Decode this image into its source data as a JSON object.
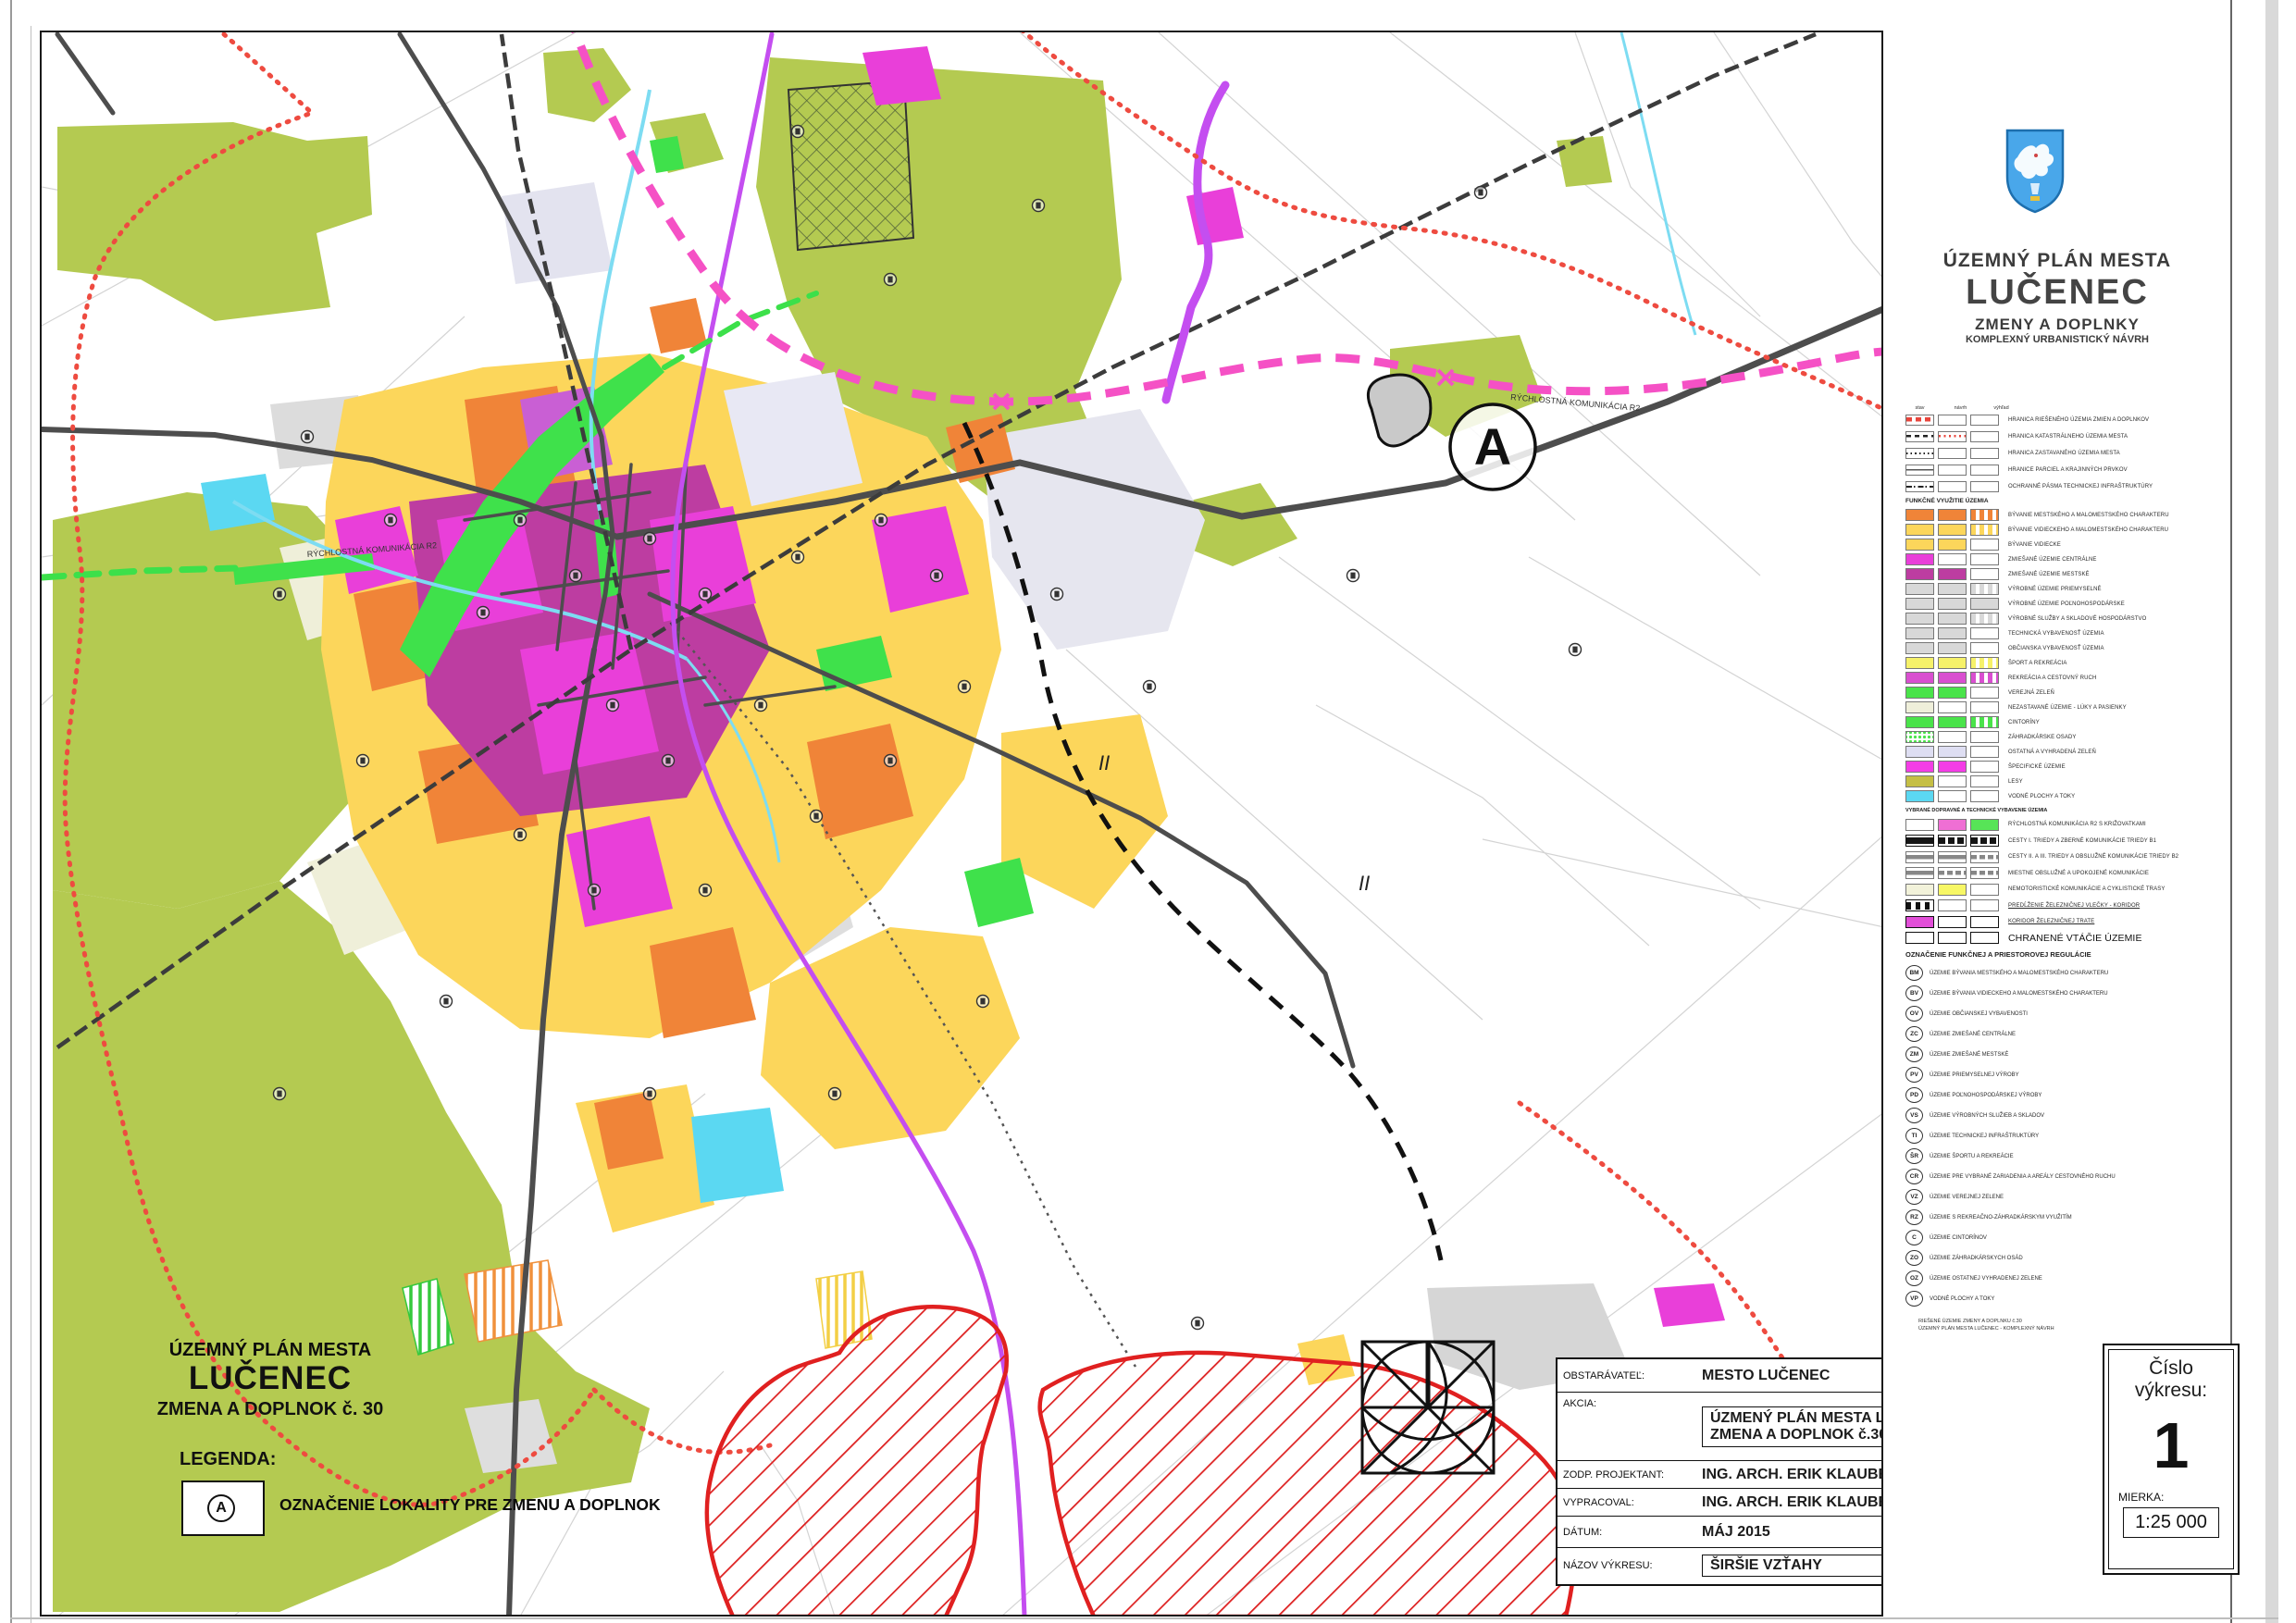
{
  "panel": {
    "title1": "ÚZEMNÝ PLÁN MESTA",
    "title2": "LUČENEC",
    "title3": "ZMENY A DOPLNKY",
    "title4": "KOMPLEXNÝ URBANISTICKÝ NÁVRH",
    "coat_of_arms_icon": "lucenec-coat-of-arms",
    "col_headers": [
      "stav",
      "návrh",
      "výhľad"
    ],
    "line_items": [
      {
        "s": [
          "line-red-dash",
          "none",
          "none"
        ],
        "label": "HRANICA RIEŠENÉHO ÚZEMIA ZMIEN A DOPLNKOV"
      },
      {
        "s": [
          "line-black-dash",
          "dots-red",
          "none"
        ],
        "label": "HRANICA KATASTRÁLNEHO ÚZEMIA MESTA"
      },
      {
        "s": [
          "line-black-dots",
          "none",
          "none"
        ],
        "label": "HRANICA ZASTAVANÉHO ÚZEMIA MESTA"
      },
      {
        "s": [
          "line-thin",
          "none",
          "none"
        ],
        "label": "HRANICE PARCIEL A KRAJINNÝCH PRVKOV"
      },
      {
        "s": [
          "line-dashdot",
          "none",
          "none"
        ],
        "label": "OCHRANNÉ PÁSMA TECHNICKEJ INFRAŠTRUKTÚRY"
      }
    ],
    "section_a_header": "FUNKČNÉ VYUŽITIE ÚZEMIA",
    "area_items": [
      {
        "s": [
          "#f08438",
          "#f08438",
          "stripe:#f08438"
        ],
        "label": "BÝVANIE MESTSKÉHO A MALOMESTSKÉHO CHARAKTERU"
      },
      {
        "s": [
          "#fcd65b",
          "#fcd65b",
          "stripe:#fcd65b"
        ],
        "label": "BÝVANIE VIDIECKEHO A MALOMESTSKÉHO CHARAKTERU"
      },
      {
        "s": [
          "#fcd65b",
          "#fcd65b",
          "none"
        ],
        "label": "BÝVANIE VIDIECKE"
      },
      {
        "s": [
          "#e93fd9",
          "none",
          "none"
        ],
        "label": "ZMIEŠANÉ ÚZEMIE CENTRÁLNE"
      },
      {
        "s": [
          "#bd3da1",
          "#bd3da1",
          "none"
        ],
        "label": "ZMIEŠANÉ ÚZEMIE MESTSKÉ"
      },
      {
        "s": [
          "#d8d8d8",
          "#d8d8d8",
          "stripe:#d8d8d8"
        ],
        "label": "VÝROBNÉ ÚZEMIE PRIEMYSELNÉ"
      },
      {
        "s": [
          "#d8d8d8",
          "#d8d8d8",
          "#d8d8d8"
        ],
        "label": "VÝROBNÉ ÚZEMIE POĽNOHOSPODÁRSKE"
      },
      {
        "s": [
          "#d8d8d8",
          "#d8d8d8",
          "stripe:#d8d8d8"
        ],
        "label": "VÝROBNÉ SLUŽBY A SKLADOVÉ HOSPODÁRSTVO"
      },
      {
        "s": [
          "#d8d8d8",
          "#d8d8d8",
          "none"
        ],
        "label": "TECHNICKÁ VYBAVENOSŤ ÚZEMIA"
      },
      {
        "s": [
          "#d8d8d8",
          "#d8d8d8",
          "none"
        ],
        "label": "OBČIANSKA VYBAVENOSŤ ÚZEMIA"
      },
      {
        "s": [
          "#f6f169",
          "#f6f169",
          "stripe:#f6f169"
        ],
        "label": "ŠPORT A REKREÁCIA"
      },
      {
        "s": [
          "#d94fd0",
          "#d94fd0",
          "stripe:#d94fd0"
        ],
        "label": "REKREÁCIA A CESTOVNÝ RUCH"
      },
      {
        "s": [
          "#4ae34a",
          "#4ae34a",
          "none"
        ],
        "label": "VEREJNÁ ZELEŇ"
      },
      {
        "s": [
          "#efefda",
          "none",
          "none"
        ],
        "label": "NEZASTAVANÉ ÚZEMIE - LÚKY A PASIENKY"
      },
      {
        "s": [
          "#4ae34a",
          "#4ae34a",
          "stripe:#4ae34a"
        ],
        "label": "CINTORÍNY"
      },
      {
        "s": [
          "dots:#4ae34a",
          "none",
          "none"
        ],
        "label": "ZÁHRADKÁRSKE OSADY"
      },
      {
        "s": [
          "#dedef2",
          "#dedef2",
          "none"
        ],
        "label": "OSTATNÁ A VYHRADENÁ ZELEŇ"
      },
      {
        "s": [
          "#f43de6",
          "#f43de6",
          "none"
        ],
        "label": "ŠPECIFICKÉ ÚZEMIE"
      },
      {
        "s": [
          "#c5bf45",
          "none",
          "none"
        ],
        "label": "LESY"
      },
      {
        "s": [
          "#5bd8f2",
          "none",
          "none"
        ],
        "label": "VODNÉ PLOCHY A TOKY"
      }
    ],
    "transport_header": "VYBRANÉ DOPRAVNÉ A TECHNICKÉ VYBAVENIE ÚZEMIA",
    "transport_items": [
      {
        "s": [
          "none",
          "#ef6fd4",
          "#57e457"
        ],
        "label": "RÝCHLOSTNÁ KOMUNIKÁCIA R2 S KRIŽOVATKAMI"
      },
      {
        "s": [
          "bar-black",
          "bar-black-seg",
          "bar-black-seg"
        ],
        "label": "CESTY I. TRIEDY A ZBERNÉ KOMUNIKÁCIE TRIEDY B1"
      },
      {
        "s": [
          "bar-gray",
          "bar-gray",
          "bar-gray-seg"
        ],
        "label": "CESTY II. A III. TRIEDY A OBSLUŽNÉ KOMUNIKÁCIE TRIEDY B2"
      },
      {
        "s": [
          "bar-gray",
          "bar-gray-seg",
          "bar-gray-seg"
        ],
        "label": "MIESTNE OBSLUŽNÉ A UPOKOJENÉ KOMUNIKÁCIE"
      },
      {
        "s": [
          "#f2f2da",
          "#f7f765",
          "none"
        ],
        "label": "NEMOTORISTICKÉ KOMUNIKÁCIE A CYKLISTICKÉ TRASY"
      },
      {
        "s": [
          "rail",
          "none",
          "none"
        ],
        "label": "PREDĹŽENIE ŽELEZNIČNEJ VLEČKY - KORIDOR",
        "u": true
      },
      {
        "s": [
          "magenta-border",
          "border-bold",
          "border-bold"
        ],
        "label": "KORIDOR ŽELEZNIČNEJ TRATE",
        "u": true
      },
      {
        "s": [
          "border-bold",
          "border-bold",
          "border-bold"
        ],
        "label": "CHRANENÉ VTÁČIE ÚZEMIE",
        "big": true
      }
    ],
    "section_b_header": "OZNAČENIE FUNKČNEJ A PRIESTOROVEJ REGULÁCIE",
    "code_items": [
      {
        "code": "BM",
        "label": "ÚZEMIE BÝVANIA MESTSKÉHO A MALOMESTSKÉHO CHARAKTERU"
      },
      {
        "code": "BV",
        "label": "ÚZEMIE BÝVANIA VIDIECKEHO A MALOMESTSKÉHO CHARAKTERU"
      },
      {
        "code": "OV",
        "label": "ÚZEMIE OBČIANSKEJ VYBAVENOSTI"
      },
      {
        "code": "ZC",
        "label": "ÚZEMIE ZMIEŠANÉ CENTRÁLNE"
      },
      {
        "code": "ZM",
        "label": "ÚZEMIE ZMIEŠANÉ MESTSKÉ"
      },
      {
        "code": "PV",
        "label": "ÚZEMIE PRIEMYSELNEJ VÝROBY"
      },
      {
        "code": "PD",
        "label": "ÚZEMIE POĽNOHOSPODÁRSKEJ VÝROBY"
      },
      {
        "code": "VS",
        "label": "ÚZEMIE VÝROBNÝCH SLUŽIEB A SKLADOV"
      },
      {
        "code": "TI",
        "label": "ÚZEMIE TECHNICKEJ INFRAŠTRUKTÚRY"
      },
      {
        "code": "ŠR",
        "label": "ÚZEMIE ŠPORTU A REKREÁCIE"
      },
      {
        "code": "CR",
        "label": "ÚZEMIE PRE VYBRANÉ ZARIADENIA A AREÁLY CESTOVNÉHO RUCHU"
      },
      {
        "code": "VZ",
        "label": "ÚZEMIE VEREJNEJ ZELENE"
      },
      {
        "code": "RZ",
        "label": "ÚZEMIE S REKREAČNO-ZÁHRADKÁRSKYM VYUŽITÍM"
      },
      {
        "code": "C",
        "label": "ÚZEMIE CINTORÍNOV"
      },
      {
        "code": "ZO",
        "label": "ÚZEMIE ZÁHRADKÁRSKYCH OSÁD"
      },
      {
        "code": "OZ",
        "label": "ÚZEMIE OSTATNEJ VYHRADENEJ ZELENE"
      },
      {
        "code": "VP",
        "label": "VODNÉ PLOCHY A TOKY"
      }
    ],
    "footnotes": [
      "RIEŠENÉ ÚZEMIE ZMENY A DOPLNKU č.30",
      "ÚZEMNÝ PLÁN MESTA LUČENEC - KOMPLEXNÝ NÁVRH"
    ]
  },
  "map": {
    "marker_a": "A",
    "label_ii": "II",
    "road_label_r2": "RÝCHLOSTNÁ KOMUNIKÁCIA R2"
  },
  "bottom_left": {
    "title1": "ÚZEMNÝ PLÁN MESTA",
    "title2": "LUČENEC",
    "title3": "ZMENA A DOPLNOK č. 30",
    "legend_label": "LEGENDA:",
    "marker": "A",
    "marker_desc": "OZNAČENIE LOKALITY PRE ZMENU A DOPLNOK"
  },
  "title_block": {
    "obstaravatel_label": "OBSTARÁVATEĽ:",
    "obstaravatel_value": "MESTO LUČENEC",
    "akcia_label": "AKCIA:",
    "akcia_value1": "ÚZMENÝ PLÁN MESTA LUČENEC",
    "akcia_value2": "ZMENA  A DOPLNOK č.30",
    "zodp_label": "ZODP. PROJEKTANT:",
    "zodp_value": "ING. ARCH. ERIK KLAUBERT",
    "vypracoval_label": "VYPRACOVAL:",
    "vypracoval_value": "ING. ARCH. ERIK KLAUBERT",
    "datum_label": "DÁTUM:",
    "datum_value": "MÁJ 2015",
    "nazov_label": "NÁZOV VÝKRESU:",
    "nazov_value": "ŠIRŠIE VZŤAHY"
  },
  "drawing_number": {
    "cislo_line1": "Číslo",
    "cislo_line2": "výkresu:",
    "number": "1",
    "mierka_label": "MIERKA:",
    "scale": "1:25 000"
  },
  "colors": {
    "forest": "#b4ca51",
    "residential_orange": "#f08438",
    "residential_yellow": "#fcd65b",
    "mixed_magenta": "#e93fd9",
    "mixed_dark_magenta": "#bd3da1",
    "industry_gray": "#d8d8d8",
    "green_public": "#4ae34a",
    "water_cyan": "#5bd8f2",
    "road_gray": "#4d4d4d",
    "r2_pink": "#f551c5",
    "pipeline_purple": "#c44ef0",
    "boundary_red": "#ee4b40"
  }
}
